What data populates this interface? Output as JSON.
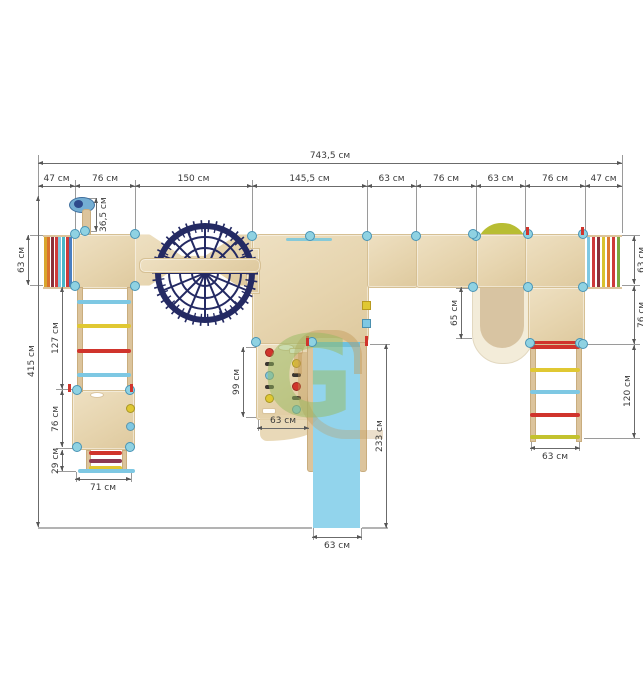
{
  "dimensions": {
    "total_width": "743,5 см",
    "top_row": [
      "47 см",
      "76 см",
      "150 см",
      "145,5 см",
      "63 см",
      "76 см",
      "63 см",
      "76 см",
      "47 см"
    ],
    "overall_depth": "415 см",
    "mast": "36,5 см",
    "left_bridge_depth": "63 см",
    "left_ladder_length": "127 см",
    "left_platform_depth": "76 см",
    "left_steps_depth": "29 см",
    "left_steps_width": "71 см",
    "climbing_wall_length": "99 см",
    "climbing_wall_width": "63 см",
    "slide_length": "233 см",
    "slide_width": "63 см",
    "tunnel_depth": "65 см",
    "right_bridge_depth": "63 см",
    "right_platform_depth": "76 см",
    "right_ladder_length": "120 см",
    "right_ladder_width": "63 см"
  },
  "watermark": {
    "letter": "G"
  },
  "colors": {
    "wood": "#e6d5b0",
    "wood_border": "#d6c094",
    "cream": "#f3ecd9",
    "tunnel_inner": "#d8c4a2",
    "net_navy": "#242a63",
    "slide_blue": "#92d4ec",
    "connector_blue": "#8fd2e2",
    "dome_green": "#b8bd33",
    "dim_line": "#6b6b6b",
    "red": "#d0342c",
    "yellow": "#e0c832",
    "lightblue": "#7ec8e3"
  },
  "left_bridge": {
    "stripes": [
      "#d9a62e",
      "#d9722e",
      "#8c2f39",
      "#cf3a3a",
      "#7ec8e3",
      "#49b6c8",
      "#cf3a3a",
      "#4a7fc1"
    ]
  },
  "right_bridge": {
    "stripes": [
      "#7ec8e3",
      "#cf3a3a",
      "#8c2f39",
      "#d9c22e",
      "#dd7a2f",
      "#cf3a3a",
      "#7aa83f"
    ]
  },
  "left_ladder": {
    "rungs": [
      "#7ec8e3",
      "#e0c832",
      "#d0342c",
      "#7ec8e3"
    ]
  },
  "right_ladder": {
    "rungs": [
      "#d0342c",
      "#e0c832",
      "#7ec8e3",
      "#d0342c",
      "#c3c22e"
    ]
  },
  "left_steps": {
    "bars": [
      "#d0342c",
      "#8c3a52",
      "#e0c832"
    ]
  },
  "climbing_wall": {
    "holds_left": [
      "#d0342c",
      "dark",
      "#7ec8e3",
      "dark",
      "#e0c832",
      "slot"
    ],
    "holds_right": [
      "slot",
      "#e0c832",
      "dark",
      "#d0342c",
      "dark",
      "#7ec8e3"
    ]
  }
}
